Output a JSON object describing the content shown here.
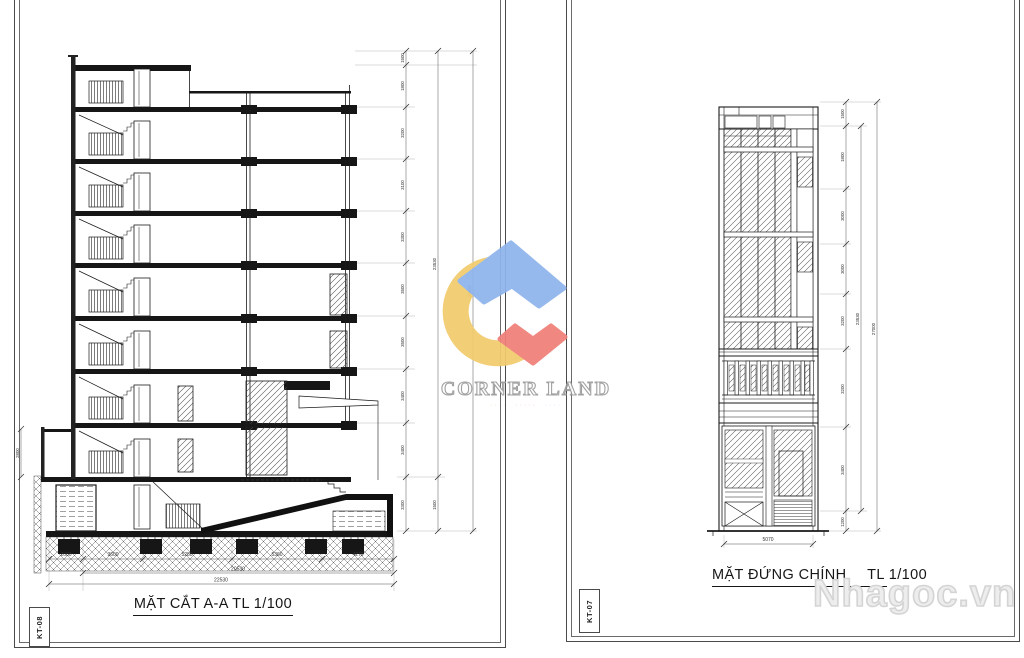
{
  "page": {
    "background": "#ffffff"
  },
  "sheet_left": {
    "code": "KT-08",
    "title": "MẶT CẮT A-A TL 1/100",
    "vertical_chain": {
      "labels": [
        "1500",
        "1800",
        "3200",
        "3100",
        "3300",
        "3500",
        "3500",
        "3400",
        "3400",
        "3300"
      ],
      "subtotal": "23530",
      "sub_extra": "1500",
      "total": "26530"
    },
    "bottom_chain": {
      "labels": [
        "2000",
        "3600",
        "5280",
        "5360",
        "4270"
      ],
      "subtotal": "20530",
      "total": "22530"
    },
    "left_dim": "2800"
  },
  "sheet_right": {
    "code": "KT-07",
    "title": "MẶT ĐỨNG CHÍNH",
    "scale": "TL 1/100",
    "vertical_chain": {
      "labels": [
        "1500",
        "1800",
        "3000",
        "3000",
        "3200",
        "3200",
        "3400",
        "1200"
      ],
      "subtotal": "23530",
      "total": "27000"
    },
    "width_dim": "5070"
  },
  "watermark": {
    "brand": "CORNER LAND",
    "site": "Nhagoc.vn",
    "colors": {
      "blue": "#8fb4ec",
      "yellow": "#f2cc6d",
      "red": "#ef8078"
    }
  }
}
